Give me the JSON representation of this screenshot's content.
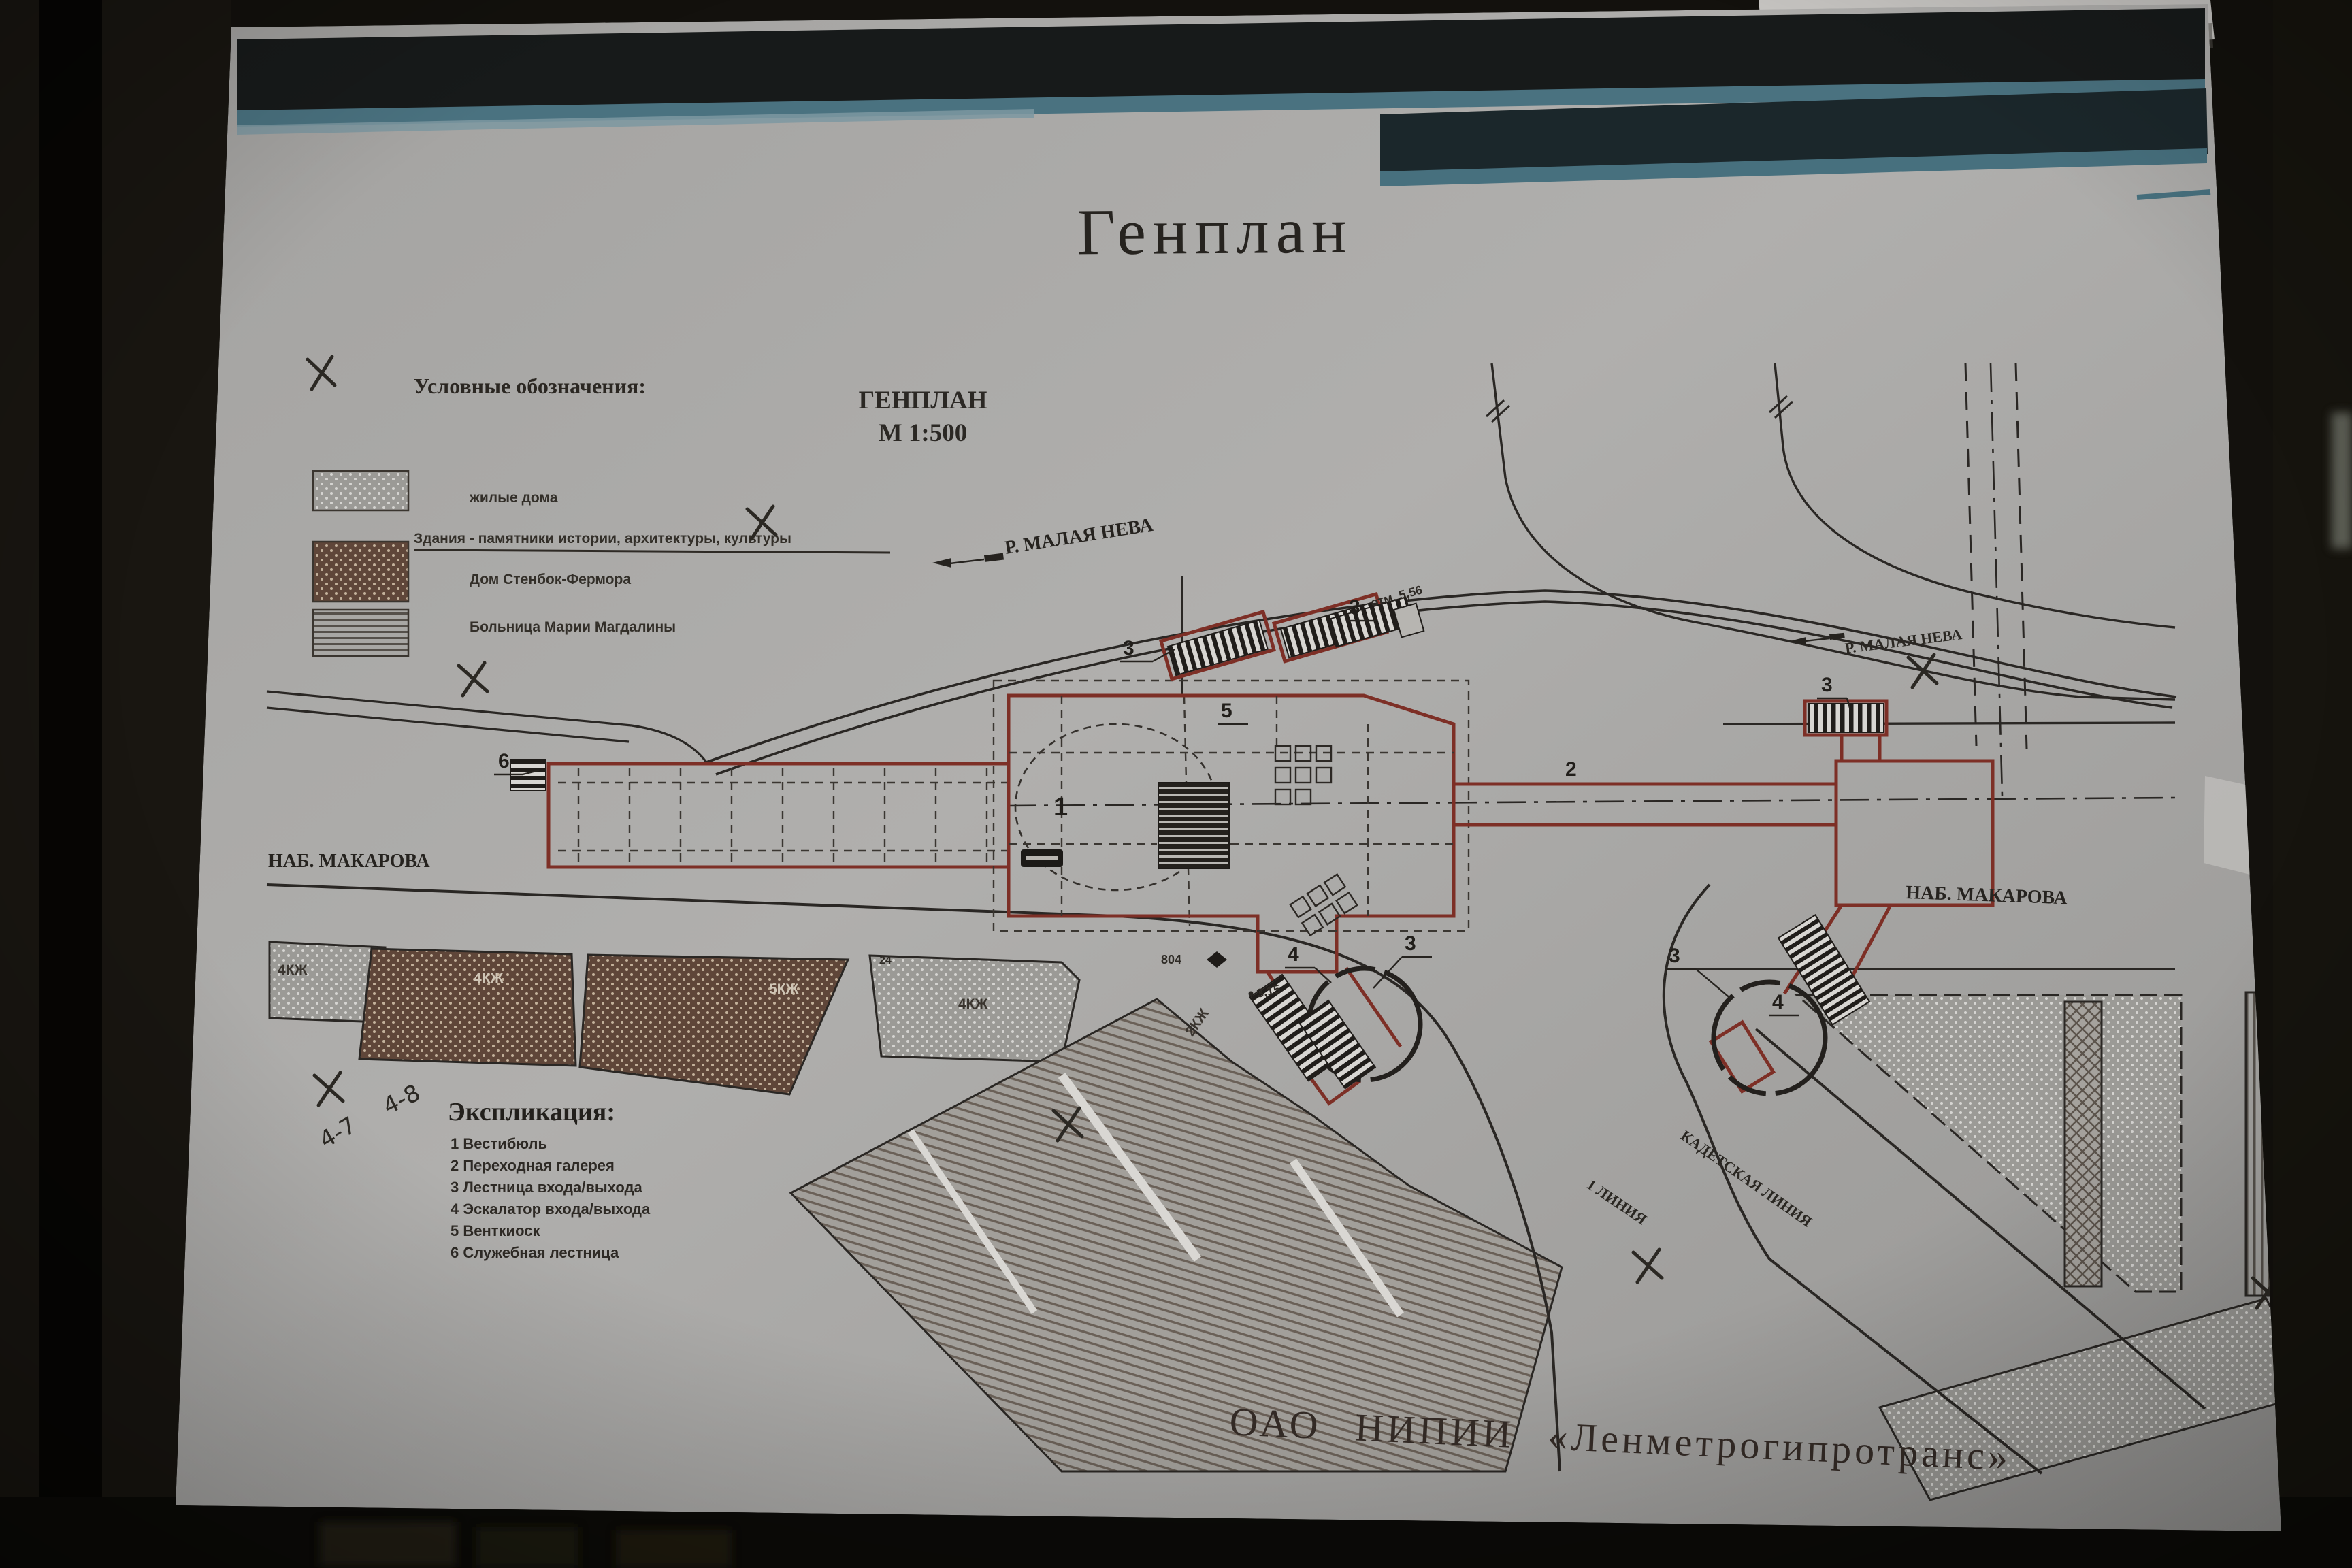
{
  "poster": {
    "title": "Генплан",
    "subtitle_line1": "ГЕНПЛАН",
    "subtitle_line2": "М 1:500",
    "organization": "ОАО НИПИИ «Ленметрогипротранс»",
    "upper_poster_fragment": "гипротранс»"
  },
  "legend": {
    "heading": "Условные обозначения:",
    "items": [
      {
        "swatch": "gray-dots",
        "label": "жилые дома"
      },
      {
        "swatch": "none",
        "label": "Здания - памятники истории, архитектуры, культуры"
      },
      {
        "swatch": "brown-dots",
        "label": "Дом Стенбок-Фермора"
      },
      {
        "swatch": "h-lines",
        "label": "Больница Марии Магдалины"
      }
    ]
  },
  "explication": {
    "heading": "Экспликация:",
    "items": [
      "1 Вестибюль",
      "2 Переходная галерея",
      "3 Лестница входа/выхода",
      "4 Эскалатор входа/выхода",
      "5 Венткиоск",
      "6 Служебная лестница"
    ]
  },
  "map_labels": {
    "river_left": "Р. МАЛАЯ НЕВА",
    "river_right": "Р. МАЛАЯ НЕВА",
    "embankment_left": "НАБ. МАКАРОВА",
    "embankment_right": "НАБ. МАКАРОВА",
    "line1_street": "1 ЛИНИЯ",
    "kadetskaya_street": "КАДЕТСКАЯ ЛИНИЯ"
  },
  "markers": {
    "n1": "1",
    "n2": "2",
    "n3": "3",
    "n4": "4",
    "n5": "5",
    "n6": "6",
    "bench": "804",
    "elev_a": "3,15",
    "elev_b": "отм. 5,56",
    "b24": "24",
    "bl_4kzh": "4КЖ",
    "bl_5kzh": "5КЖ",
    "bl_2kzh": "2КЖ"
  },
  "annotations": {
    "axis_a": "4-7",
    "axis_b": "4-8"
  },
  "colors": {
    "outline_red": "#7d2f26",
    "teal_band": "#4a7280",
    "brown_block": "#63493c",
    "paper": "#aaa9a7"
  }
}
